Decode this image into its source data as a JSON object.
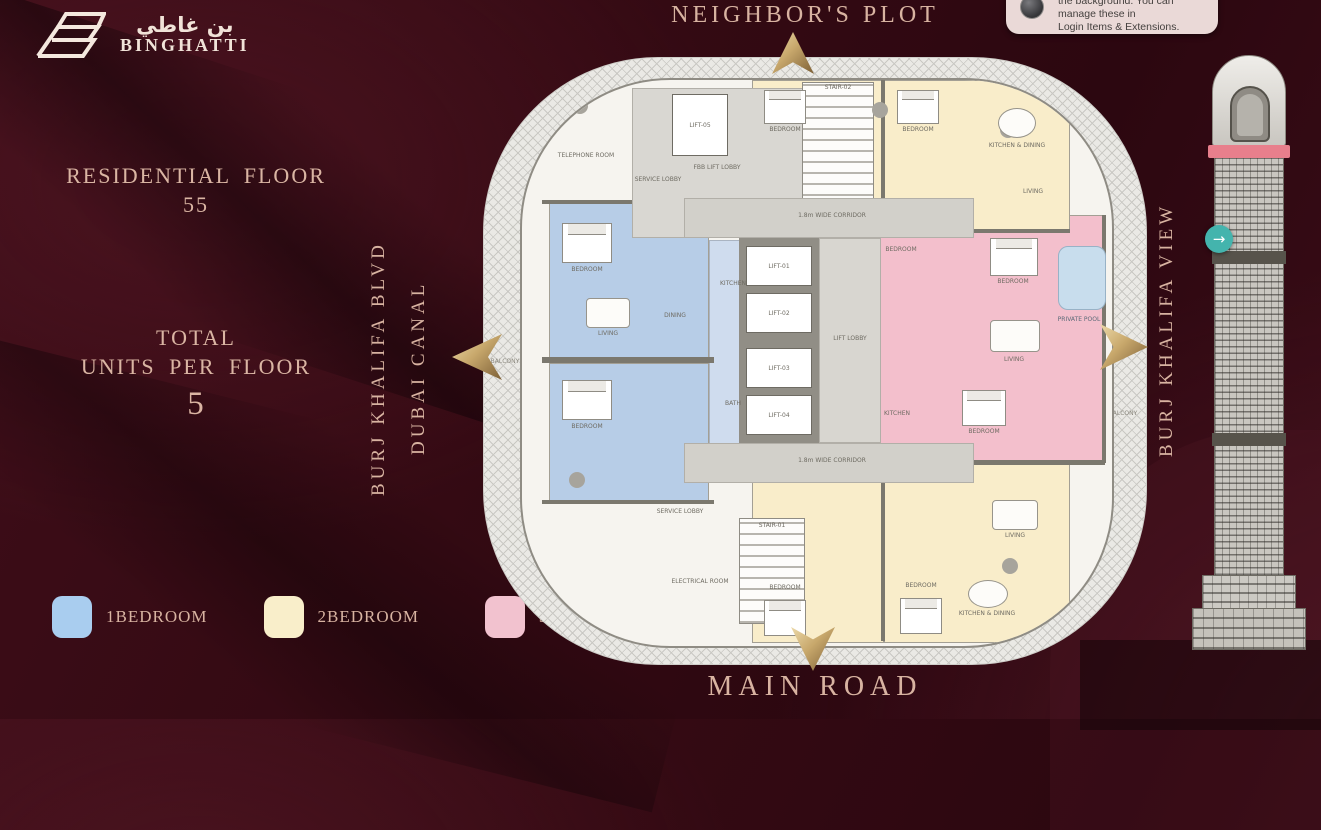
{
  "brand": {
    "arabic": "بن غاطي",
    "latin": "BINGHATTI"
  },
  "notification": {
    "line1": "the background. You can manage these in",
    "line2": "Login Items & Extensions."
  },
  "left_panel": {
    "residential_floor_label": "RESIDENTIAL FLOOR",
    "residential_floor_value": "55",
    "total_label": "TOTAL",
    "units_label": "UNITS PER FLOOR",
    "units_value": "5"
  },
  "surroundings": {
    "top": "NEIGHBOR'S PLOT",
    "bottom": "MAIN ROAD",
    "left_outer": "BURJ KHALIFA BLVD",
    "left_inner": "DUBAI CANAL",
    "right": "BURJ KHALIFA VIEW"
  },
  "legend": {
    "one_bed": {
      "label": "1BEDROOM",
      "color": "#a9cdef"
    },
    "two_bed": {
      "label": "2BEDROOM",
      "color": "#f9eeca"
    },
    "three_bed": {
      "label": "3BEDROOM",
      "color": "#f2c2cf"
    }
  },
  "floor_plan": {
    "corridor": "1.8m WIDE CORRIDOR",
    "lift_lobby": "LIFT LOBBY",
    "fbb_lift_lobby": "FBB LIFT LOBBY",
    "lift_01": "LIFT-01",
    "lift_02": "LIFT-02",
    "lift_03": "LIFT-03",
    "lift_04": "LIFT-04",
    "lift_05": "LIFT-05",
    "stair_top": "STAIR-02",
    "stair_bottom": "STAIR-01",
    "service_lobby": "SERVICE LOBBY",
    "telephone_room": "TELEPHONE ROOM",
    "electrical_room": "ELECTRICAL ROOM",
    "private_pool": "PRIVATE POOL",
    "jacuzzi": "JACUZZI",
    "balcony": "BALCONY",
    "bedroom": "BEDROOM",
    "living": "LIVING",
    "dining": "DINING",
    "kitchen": "KITCHEN",
    "bath": "BATH",
    "kitchen_dining": "KITCHEN & DINING"
  },
  "nav": {
    "next_icon": "→"
  }
}
